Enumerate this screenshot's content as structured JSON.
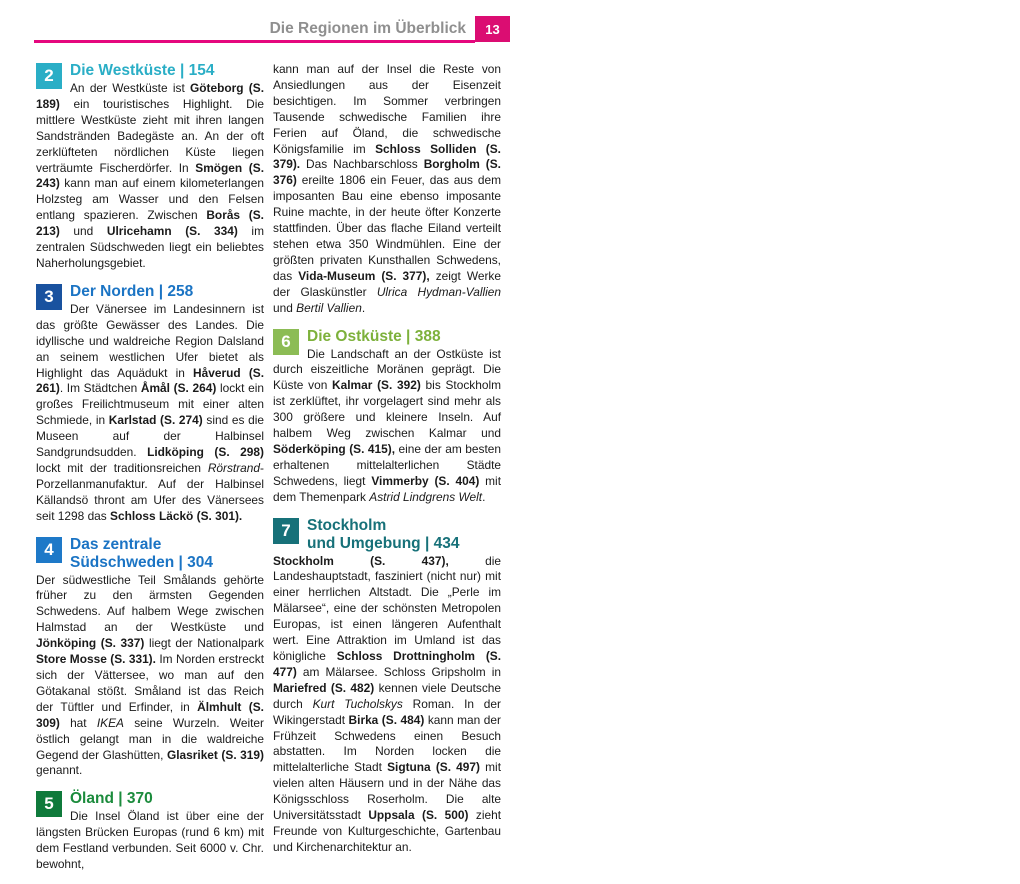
{
  "left": {
    "page_number": "12",
    "title": "Die Regionen im Überblick",
    "credit": "© Reise Know-How",
    "credit_small": "Schwab 8/06",
    "map": {
      "schweden": "SCHWEDEN",
      "sea_color": "#d9edf6",
      "land_color": "#c9dba4",
      "neighbor_color": "#f9f3dd",
      "boxes": [
        {
          "n": "1",
          "x": 128,
          "y": 426,
          "color": "#156f76"
        },
        {
          "n": "2",
          "x": 66,
          "y": 263,
          "color": "#2aaec6"
        },
        {
          "n": "3",
          "x": 121,
          "y": 89,
          "color": "#19529f"
        },
        {
          "n": "4",
          "x": 215,
          "y": 264,
          "color": "#1e79c8"
        },
        {
          "n": "5",
          "x": 319,
          "y": 353,
          "color": "#0f7a3b"
        },
        {
          "n": "6",
          "x": 314,
          "y": 231,
          "color": "#8cbc55"
        },
        {
          "n": "7",
          "x": 308,
          "y": 68,
          "color": "#177179"
        }
      ],
      "dots": [
        {
          "x": 15,
          "y": 79
        },
        {
          "x": 157,
          "y": 75
        },
        {
          "x": 188,
          "y": 89
        },
        {
          "x": 262,
          "y": 93
        },
        {
          "x": 213,
          "y": 92
        },
        {
          "x": 107,
          "y": 104
        },
        {
          "x": 88,
          "y": 140
        },
        {
          "x": 182,
          "y": 147
        },
        {
          "x": 170,
          "y": 157
        },
        {
          "x": 128,
          "y": 180
        },
        {
          "x": 14,
          "y": 181
        },
        {
          "x": 406,
          "y": 55
        },
        {
          "x": 409,
          "y": 76
        },
        {
          "x": 365,
          "y": 101
        },
        {
          "x": 424,
          "y": 94,
          "r": 7
        },
        {
          "x": 310,
          "y": 174
        },
        {
          "x": 316,
          "y": 189
        },
        {
          "x": 47,
          "y": 260
        },
        {
          "x": 144,
          "y": 255
        },
        {
          "x": 109,
          "y": 260
        },
        {
          "x": 185,
          "y": 261
        },
        {
          "x": 302,
          "y": 277
        },
        {
          "x": 96,
          "y": 380
        },
        {
          "x": 175,
          "y": 384
        },
        {
          "x": 315,
          "y": 393
        },
        {
          "x": 77,
          "y": 450
        },
        {
          "x": 211,
          "y": 449
        },
        {
          "x": 241,
          "y": 448
        },
        {
          "x": 250,
          "y": 458
        },
        {
          "x": 169,
          "y": 456
        },
        {
          "x": 172,
          "y": 473
        },
        {
          "x": 55,
          "y": 496,
          "r": 6.5
        },
        {
          "x": 92,
          "y": 504
        },
        {
          "x": 139,
          "y": 526
        }
      ],
      "labels": [
        {
          "t": "NORWEGEN",
          "x": 20,
          "y": 26,
          "c": "country-v"
        },
        {
          "t": "Fredrikstad",
          "x": 22,
          "y": 84
        },
        {
          "t": "Karlstad",
          "x": 140,
          "y": 52
        },
        {
          "t": "Kristinehamn",
          "x": 171,
          "y": 64
        },
        {
          "t": "Örebro",
          "x": 233,
          "y": 69
        },
        {
          "t": "Karlskoga",
          "x": 189,
          "y": 95
        },
        {
          "t": "Åmål",
          "x": 77,
          "y": 91
        },
        {
          "t": "Håverud",
          "x": 52,
          "y": 126
        },
        {
          "t": "Sjötorp",
          "x": 161,
          "y": 125
        },
        {
          "t": "Mariestad",
          "x": 132,
          "y": 157
        },
        {
          "t": "Lidköping",
          "x": 106,
          "y": 181
        },
        {
          "t": "Smögen",
          "x": 22,
          "y": 175
        },
        {
          "t": "Kållandsö",
          "x": 58,
          "y": 152,
          "c": "pen"
        },
        {
          "t": "Vänern",
          "x": 112,
          "y": 128,
          "c": "lake",
          "rot": -32
        },
        {
          "t": "Vättern",
          "x": 212,
          "y": 146,
          "c": "lake",
          "rot": 78
        },
        {
          "t": "Mälarsee",
          "x": 342,
          "y": 58,
          "c": "lake",
          "rot": 16
        },
        {
          "t": "Uppsala",
          "x": 412,
          "y": 46
        },
        {
          "t": "Sigtuna",
          "x": 413,
          "y": 63
        },
        {
          "t": "Birka",
          "x": 346,
          "y": 79,
          "c": "site"
        },
        {
          "t": "Mariefred",
          "x": 334,
          "y": 102
        },
        {
          "t": "Stockholm",
          "x": 391,
          "y": 95,
          "c": "big"
        },
        {
          "t": "Norrköping",
          "x": 317,
          "y": 167
        },
        {
          "t": "Söderköping",
          "x": 322,
          "y": 182
        },
        {
          "t": "★",
          "x": 215,
          "y": 141,
          "c": "star"
        },
        {
          "t": "Nationalpark",
          "x": 224,
          "y": 143,
          "c": "park"
        },
        {
          "t": "Tiveden",
          "x": 228,
          "y": 152,
          "c": "park"
        },
        {
          "t": "Göteborg",
          "x": 19,
          "y": 240
        },
        {
          "t": "Ulricehamm",
          "x": 147,
          "y": 236
        },
        {
          "t": "Borås",
          "x": 102,
          "y": 261
        },
        {
          "t": "Jönköping",
          "x": 157,
          "y": 263
        },
        {
          "t": "Vimmerby",
          "x": 310,
          "y": 270
        },
        {
          "t": "★",
          "x": 152,
          "y": 311,
          "c": "star2"
        },
        {
          "t": "Nationalpark",
          "x": 166,
          "y": 311,
          "c": "park2"
        },
        {
          "t": "Store Mosse",
          "x": 168,
          "y": 322,
          "c": "park2"
        },
        {
          "t": "Halmstad",
          "x": 73,
          "y": 380
        },
        {
          "t": "Älmhult",
          "x": 144,
          "y": 385
        },
        {
          "t": "Kalmar",
          "x": 321,
          "y": 386
        },
        {
          "t": "Öland",
          "x": 353,
          "y": 355,
          "c": "isl"
        },
        {
          "t": "Kattegat",
          "x": 17,
          "y": 400,
          "c": "water"
        },
        {
          "t": "OSTSEE",
          "x": 224,
          "y": 482,
          "c": "waterXL"
        },
        {
          "t": "Helsingborg",
          "x": 70,
          "y": 431
        },
        {
          "t": "Karlshamn",
          "x": 167,
          "y": 429
        },
        {
          "t": "Ronneby",
          "x": 219,
          "y": 429
        },
        {
          "t": "Karlskrona",
          "x": 254,
          "y": 451
        },
        {
          "t": "Kristianstad",
          "x": 109,
          "y": 453
        },
        {
          "t": "Åhus",
          "x": 177,
          "y": 463
        },
        {
          "t": "Kopenhagen",
          "x": 20,
          "y": 469,
          "c": "med"
        },
        {
          "t": "DÄNEMARK",
          "x": 20,
          "y": 498,
          "c": "country",
          "rot": -6
        },
        {
          "t": "Malmö",
          "x": 99,
          "y": 496
        },
        {
          "t": "Ystad",
          "x": 143,
          "y": 509
        },
        {
          "t": "Bornholm",
          "x": 230,
          "y": 541,
          "c": "isl"
        },
        {
          "t": "(DK)",
          "x": 235,
          "y": 555,
          "c": "dk"
        }
      ]
    },
    "section": {
      "number": "1",
      "color": "#156f76",
      "heading": "Der Süden | 24",
      "col1": "Die meisten Besucher betreten schwedischen Boden über die südlichste Provinz des Landes, Skåne (dt.: Schonen), die bis 1658 dänisch war. Die Gegend ist bekannt für ihre weiten Felder und gilt als Kornkammer Schwedens.",
      "col2": "Geschichtsträchtige Hafenstädte wie <b>Malmö (S. 35)</b> und <b>Ystad (S. 78)</b> liegen am Meer. Größere Orte sind <b>Karlshamn (S. 130)</b> und <b>Ronneby (S. 138)</b> sowie der Stützpunkt der Königlichen Kriegsflotte, <b>Karlskrona (S. 142).</b>"
    }
  },
  "right": {
    "page_number": "13",
    "title": "Die Regionen im Überblick",
    "columns": [
      [
        {
          "num": "2",
          "box": "#2aaec6",
          "hcolor": "#2aaec6",
          "heading": [
            "Die Westküste | 154"
          ],
          "html": "An der Westküste ist <b>Göteborg (S. 189)</b> ein touristisches Highlight. Die mittlere Westküste zieht mit ihren langen Sandstränden Badegäste an. An der oft zerklüfteten nördlichen Küste liegen verträumte Fischerdörfer. In <b>Smögen (S. 243)</b> kann man auf einem kilometerlangen Holzsteg am Wasser und den Felsen entlang spazieren. Zwischen <b>Borås (S. 213)</b> und <b>Ulricehamn (S. 334)</b> im zentralen Südschweden liegt ein beliebtes Naherholungsgebiet."
        },
        {
          "num": "3",
          "box": "#19529f",
          "hcolor": "#1b74c4",
          "heading": [
            "Der Norden | 258"
          ],
          "html": "Der Vänersee im Landesinnern ist das größte Gewässer des Landes. Die idyllische und waldreiche Region Dalsland an seinem westlichen Ufer bietet als Highlight das Aquädukt in <b>Håverud (S. 261)</b>. Im Städtchen <b>Åmål (S. 264)</b> lockt ein großes Freilichtmuseum mit einer alten Schmiede, in <b>Karlstad (S. 274)</b> sind es die Museen auf der Halbinsel Sandgrundsudden. <b>Lidköping (S. 298)</b> lockt mit der traditionsreichen <i>Rörstrand</i>-Porzellanmanufaktur. Auf der Halbinsel Källandsö thront am Ufer des Vänersees seit 1298 das <b>Schloss Läckö (S. 301).</b>"
        },
        {
          "num": "4",
          "box": "#1e79c8",
          "hcolor": "#1b74c4",
          "heading": [
            "Das zentrale",
            "Südschweden | 304"
          ],
          "html": "Der südwestliche Teil Smålands gehörte früher zu den ärmsten Gegenden Schwedens. Auf halbem Wege zwischen Halmstad an der Westküste und <b>Jönköping (S. 337)</b> liegt der Nationalpark <b>Store Mosse (S. 331).</b> Im Norden erstreckt sich der Vättersee, wo man auf den Götakanal stößt. Småland ist das Reich der Tüftler und Erfinder, in <b>Älmhult (S. 309)</b> hat <i>IKEA</i> seine Wurzeln. Weiter östlich gelangt man in die waldreiche Gegend der Glashütten, <b>Glasriket (S. 319)</b> genannt."
        },
        {
          "num": "5",
          "box": "#0f7a3b",
          "hcolor": "#1b8b3c",
          "heading": [
            "Öland | 370"
          ],
          "html": "Die Insel Öland ist über eine der längsten Brücken Europas (rund 6 km) mit dem Festland verbunden. Seit 6000 v. Chr. bewohnt,"
        }
      ],
      [
        {
          "num": null,
          "html": "kann man auf der Insel die Reste von Ansiedlungen aus der Eisenzeit besichtigen. Im Sommer verbringen Tausende schwedische Familien ihre Ferien auf Öland, die schwedische Königsfamilie im <b>Schloss Solliden (S. 379).</b> Das Nachbarschloss <b>Borgholm (S. 376)</b> ereilte 1806 ein Feuer, das aus dem imposanten Bau eine ebenso imposante Ruine machte, in der heute öfter Konzerte stattfinden. Über das flache Eiland verteilt stehen etwa 350 Windmühlen. Eine der größten privaten Kunsthallen Schwedens, das <b>Vida-Museum (S. 377),</b> zeigt Werke der Glaskünstler <i>Ulrica Hydman-Vallien</i> und <i>Bertil Vallien</i>."
        },
        {
          "num": "6",
          "box": "#8cbc55",
          "hcolor": "#7db13b",
          "heading": [
            "Die Ostküste | 388"
          ],
          "html": "Die Landschaft an der Ostküste ist durch eiszeitliche Moränen geprägt. Die Küste von <b>Kalmar (S. 392)</b> bis Stockholm ist zerklüftet, ihr vorgelagert sind mehr als 300 größere und kleinere Inseln. Auf halbem Weg zwischen Kalmar und <b>Söderköping (S. 415),</b> eine der am besten erhaltenen mittelalterlichen Städte Schwedens, liegt <b>Vimmerby (S. 404)</b> mit dem Themenpark <i>Astrid Lindgrens Welt</i>."
        },
        {
          "num": "7",
          "box": "#177179",
          "hcolor": "#177179",
          "heading": [
            "Stockholm",
            "und Umgebung | 434"
          ],
          "html": "<b>Stockholm (S. 437),</b> die Landeshauptstadt, fasziniert (nicht nur) mit einer herrlichen Altstadt. Die „Perle im Mälarsee“, eine der schönsten Metropolen Europas, ist einen längeren Aufenthalt wert. Eine Attraktion im Umland ist das königliche <b>Schloss Drottningholm (S. 477)</b> am Mälarsee. Schloss Gripsholm in <b>Mariefred (S. 482)</b> kennen viele Deutsche durch <i>Kurt Tucholskys</i> Roman. In der Wikingerstadt <b>Birka (S. 484)</b> kann man der Frühzeit Schwedens einen Besuch abstatten. Im Norden locken die mittelalterliche Stadt <b>Sigtuna (S. 497)</b> mit vielen alten Häusern und in der Nähe das Königsschloss Roserholm. Die alte Universitätsstadt <b>Uppsala (S. 500)</b> zieht Freunde von Kulturgeschichte, Gartenbau und Kirchenarchitektur an."
        }
      ]
    ]
  }
}
